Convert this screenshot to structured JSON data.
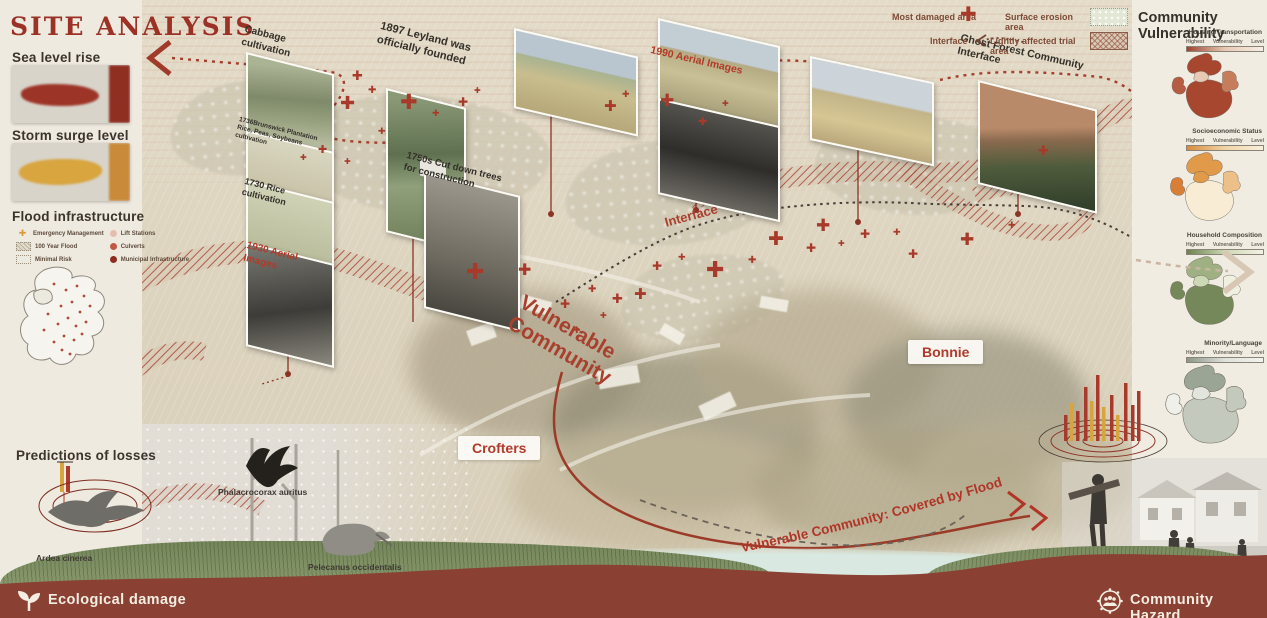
{
  "title": "SITE ANALYSIS",
  "palette": {
    "accent_red": "#9c3126",
    "marker_red": "#a73a2a",
    "footer_red": "#8a4134",
    "legend_orange": "#d99a3c",
    "vuln_green": "#75885a",
    "vuln_gray": "#9aa596"
  },
  "left_panel": {
    "sea_level_label": "Sea level rise",
    "storm_surge_label": "Storm surge level",
    "flood_infra_label": "Flood infrastructure",
    "flood_legend": [
      {
        "icon": "emergency-cross-icon",
        "label": "Emergency Management"
      },
      {
        "icon": "flood-100yr-swatch",
        "label": "100 Year Flood"
      },
      {
        "icon": "minimal-risk-swatch",
        "label": "Minimal Risk"
      },
      {
        "icon": "lift-stations-dot",
        "label": "Lift Stations"
      },
      {
        "icon": "culverts-dot",
        "label": "Culverts"
      },
      {
        "icon": "municipal-infrastructure-dot",
        "label": "Municipal Infrastructure"
      }
    ],
    "predictions_label": "Predictions of losses",
    "heron_species": "Ardea cinerea"
  },
  "hazard_legend": {
    "most_damaged": "Most damaged area",
    "surface_erosion": "Surface erosion area",
    "interface": "Interface",
    "lightly_affected": "Lightly affected trial area"
  },
  "timeline": {
    "cabbage": "Cabbage cultivation",
    "brunswick": "1736Brunswick Plantation Rice, Peas, Soybeans cultivation",
    "rice_1730": "1730 Rice cultivation",
    "aerial_1930": "1930 Aerial Images",
    "leyland_1897": "1897 Leyland was officially founded",
    "cutdown_1750s": "1750s Cut down trees for construction",
    "aerial_1990": "1990 Aerial Images",
    "ghost_forest": "Ghost Forest Community Interface"
  },
  "map_annotations": {
    "interface": "Interface",
    "vulnerable_community": "Vulnerable Community",
    "crofters": "Crofters",
    "bonnie": "Bonnie",
    "covered_by_flood": "Vulnerable Community: Covered by Flood"
  },
  "wildlife": {
    "cormorant": "Phalacrocorax auritus",
    "pelican": "Pelecanus occidentalis"
  },
  "right_panel": {
    "title": "Community Vulnerability",
    "scale_labels": [
      "Highest",
      "Vulnerability",
      "Level"
    ],
    "maps": [
      {
        "label": "Housing/Transportation"
      },
      {
        "label": "Socioeconomic Status"
      },
      {
        "label": "Household Composition"
      },
      {
        "label": "Minority/Language"
      }
    ]
  },
  "footer": {
    "ecological": "Ecological damage",
    "community": "Community Hazard"
  }
}
